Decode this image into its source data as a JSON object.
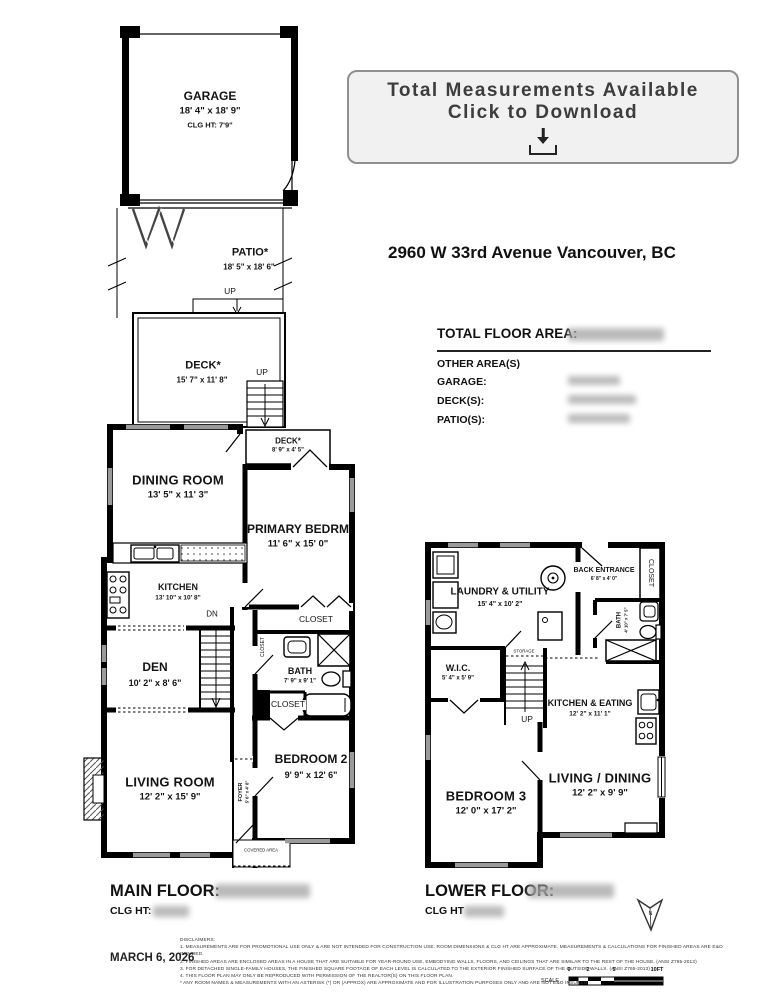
{
  "banner": {
    "line1": "Total Measurements Available",
    "line2": "Click to Download"
  },
  "address": "2960 W 33rd Avenue Vancouver, BC",
  "summary": {
    "total_label": "TOTAL FLOOR AREA:",
    "other_label": "OTHER AREA(S)",
    "garage_label": "GARAGE:",
    "decks_label": "DECK(S):",
    "patios_label": "PATIO(S):"
  },
  "garage": {
    "name": "GARAGE",
    "dims": "18' 4\" x 18' 9\"",
    "clg": "CLG HT:  7'9\""
  },
  "outdoor": {
    "patio_name": "PATIO*",
    "patio_dims": "18' 5\" x 18' 6\"",
    "deck_name": "DECK*",
    "deck_dims": "15' 7\" x 11' 8\"",
    "up_top": "UP",
    "up_deck": "UP"
  },
  "main_floor": {
    "dining": {
      "name": "DINING ROOM",
      "dims": "13' 5\" x 11' 3\""
    },
    "deck_small": {
      "name": "DECK*",
      "dims": "8' 9\" x 4' 5\""
    },
    "primary": {
      "name": "PRIMARY BEDRM",
      "dims": "11' 6\" x 15' 0\""
    },
    "kitchen": {
      "name": "KITCHEN",
      "dims": "13' 10\" x 10' 8\""
    },
    "den": {
      "name": "DEN",
      "dims": "10' 2\" x 8' 6\""
    },
    "bath": {
      "name": "BATH",
      "dims": "7' 9\" x 9' 1\""
    },
    "living": {
      "name": "LIVING ROOM",
      "dims": "12' 2\" x 15' 9\""
    },
    "bedroom2": {
      "name": "BEDROOM 2",
      "dims": "9' 9\" x 12' 6\""
    },
    "foyer": {
      "name": "FOYER",
      "dims": "5' 6\" x 4' 8\""
    },
    "closet_primary": "CLOSET",
    "closet_hall": "CLOSET",
    "closet_bed2": "CLOSET",
    "dn": "DN",
    "covered": "COVERED AREA"
  },
  "lower_floor": {
    "laundry": {
      "name": "LAUNDRY & UTILITY",
      "dims": "15' 4\" x 10' 2\""
    },
    "back_entrance": {
      "name": "BACK ENTRANCE",
      "dims": "6' 8\" x 4' 0\""
    },
    "closet": "CLOSET",
    "bath": {
      "name": "BATH",
      "dims": "4' 10\" x 7' 5\""
    },
    "wic": {
      "name": "W.I.C.",
      "dims": "5' 4\" x 5' 9\""
    },
    "kitchen_eating": {
      "name": "KITCHEN & EATING",
      "dims": "12' 2\" x 11' 1\""
    },
    "living_dining": {
      "name": "LIVING / DINING",
      "dims": "12' 2\" x 9' 9\""
    },
    "bedroom3": {
      "name": "BEDROOM 3",
      "dims": "12' 0\" x 17' 2\""
    },
    "storage": "STORAGE",
    "up": "UP"
  },
  "footer": {
    "main_label": "MAIN FLOOR:",
    "main_clg": "CLG HT:",
    "lower_label": "LOWER FLOOR:",
    "lower_clg": "CLG HT",
    "date": "MARCH 6, 2026",
    "north": "N",
    "disclaimers_title": "DISCLAIMERS:",
    "disclaimers": [
      "1. MEASUREMENTS ARE FOR PROMOTIONAL USE ONLY & ARE NOT INTENDED FOR CONSTRUCTION USE. ROOM DIMENSIONS & CLG HT ARE APPROXIMATE. MEASUREMENTS & CALCULATIONS FOR FINISHED AREAS ARE E&O INSURED.",
      "2. FINISHED AREAS ARE ENCLOSED AREAS IN A HOUSE THAT ARE SUITABLE FOR YEAR-ROUND USE, EMBODYING WALLS, FLOORS, AND CEILINGS THAT ARE SIMILAR TO THE REST OF THE HOUSE. (ANSI Z765-2013)",
      "3. FOR DETACHED SINGLE-FAMILY HOUSES, THE FINISHED SQUARE FOOTAGE OF EACH LEVEL IS CALCULATED TO THE EXTERIOR FINISHED SURFACE OF THE OUTSIDE WALLS. (ANSI Z765-2013)",
      "4. THIS FLOOR PLAN MAY ONLY BE REPRODUCED WITH PERMISSION OF THE REALTOR(S) ON THIS FLOOR PLAN.",
      "* ANY ROOM NAMES & MEASUREMENTS WITH AN ASTERISK (*) OR (APPROX) ARE APPROXIMATE AND FOR ILLUSTRATION PURPOSES ONLY AND ARE NOT E&O INSURED."
    ],
    "scale_label": "SCALE",
    "scale_ticks": [
      "0",
      "2",
      "5",
      "10FT"
    ]
  }
}
